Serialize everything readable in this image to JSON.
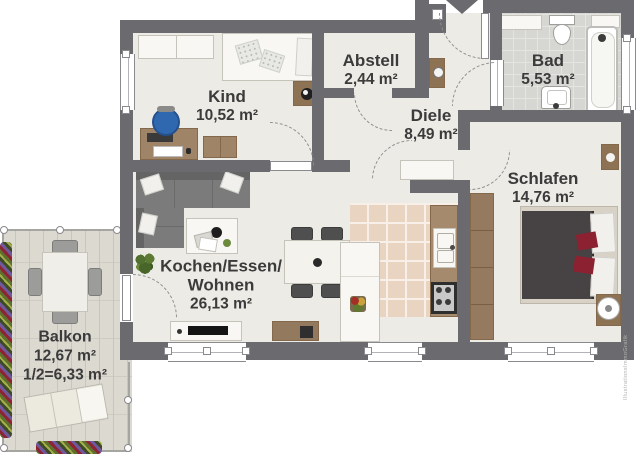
{
  "plan": {
    "watermark": "IllustrationsImmoGrafik",
    "rooms": [
      {
        "name": "Kind",
        "area": "10,52 m²"
      },
      {
        "name": "Abstell",
        "area": "2,44 m²"
      },
      {
        "name": "Diele",
        "area": "8,49 m²"
      },
      {
        "name": "Bad",
        "area": "5,53 m²"
      },
      {
        "name": "Schlafen",
        "area": "14,76 m²"
      },
      {
        "name_line1": "Kochen/Essen/",
        "name_line2": "Wohnen",
        "area": "26,13 m²"
      },
      {
        "name": "Balkon",
        "area": "12,67 m²",
        "area_half": "1/2=6,33 m²"
      }
    ],
    "colors": {
      "wall": "#6b6b6f",
      "floor": "#ecebe6",
      "bath_tile": "#d6d6d3",
      "kitchen_tile": "#e9d4c2",
      "wood": "#a08467",
      "balcony_floor": "#dcd9d1",
      "accent_red": "#8c2231",
      "chair_blue": "#3068b0",
      "text": "#3b3b3b"
    }
  }
}
